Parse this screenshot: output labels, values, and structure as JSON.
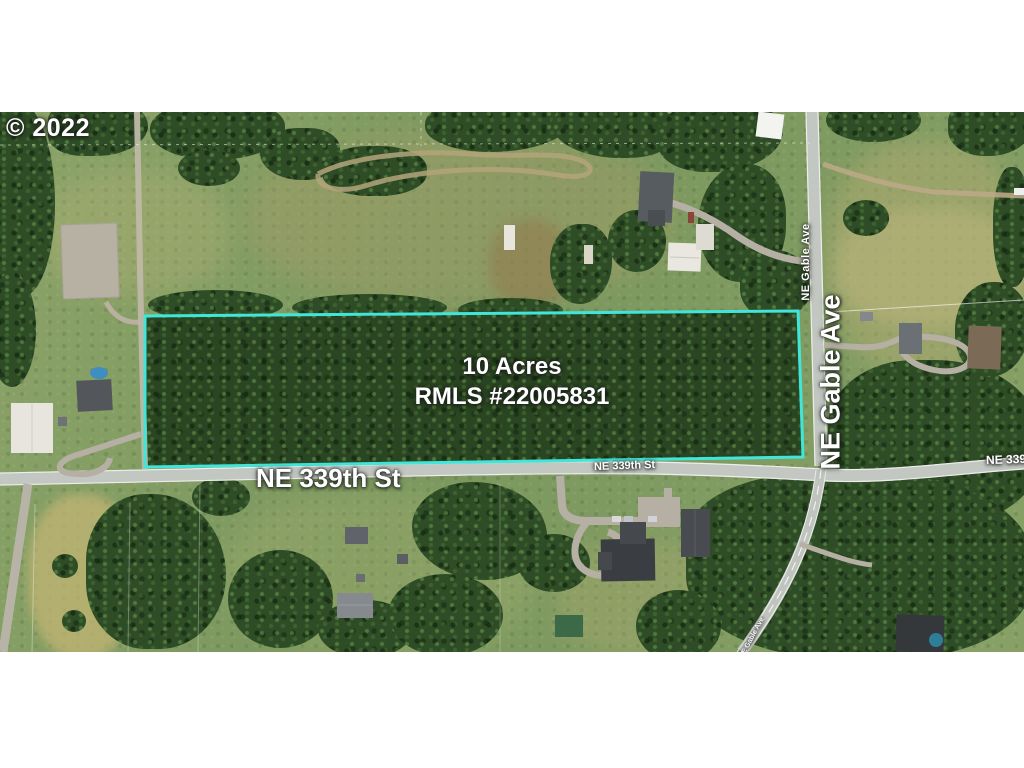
{
  "watermark": {
    "text": "© 2022"
  },
  "parcel": {
    "area": "10 Acres",
    "mls": "RMLS #22005831",
    "boundary_color": "#40E6DA"
  },
  "labels": {
    "ne_339th_main": "NE 339th St",
    "ne_339th_on_road": "NE 339th St",
    "ne_339th_right_edge": "NE 339th St",
    "ne_gable_main": "NE Gable Ave",
    "ne_gable_on_road": "NE Gable Ave",
    "ne_gable_bottom": "NE Gable Ave"
  }
}
